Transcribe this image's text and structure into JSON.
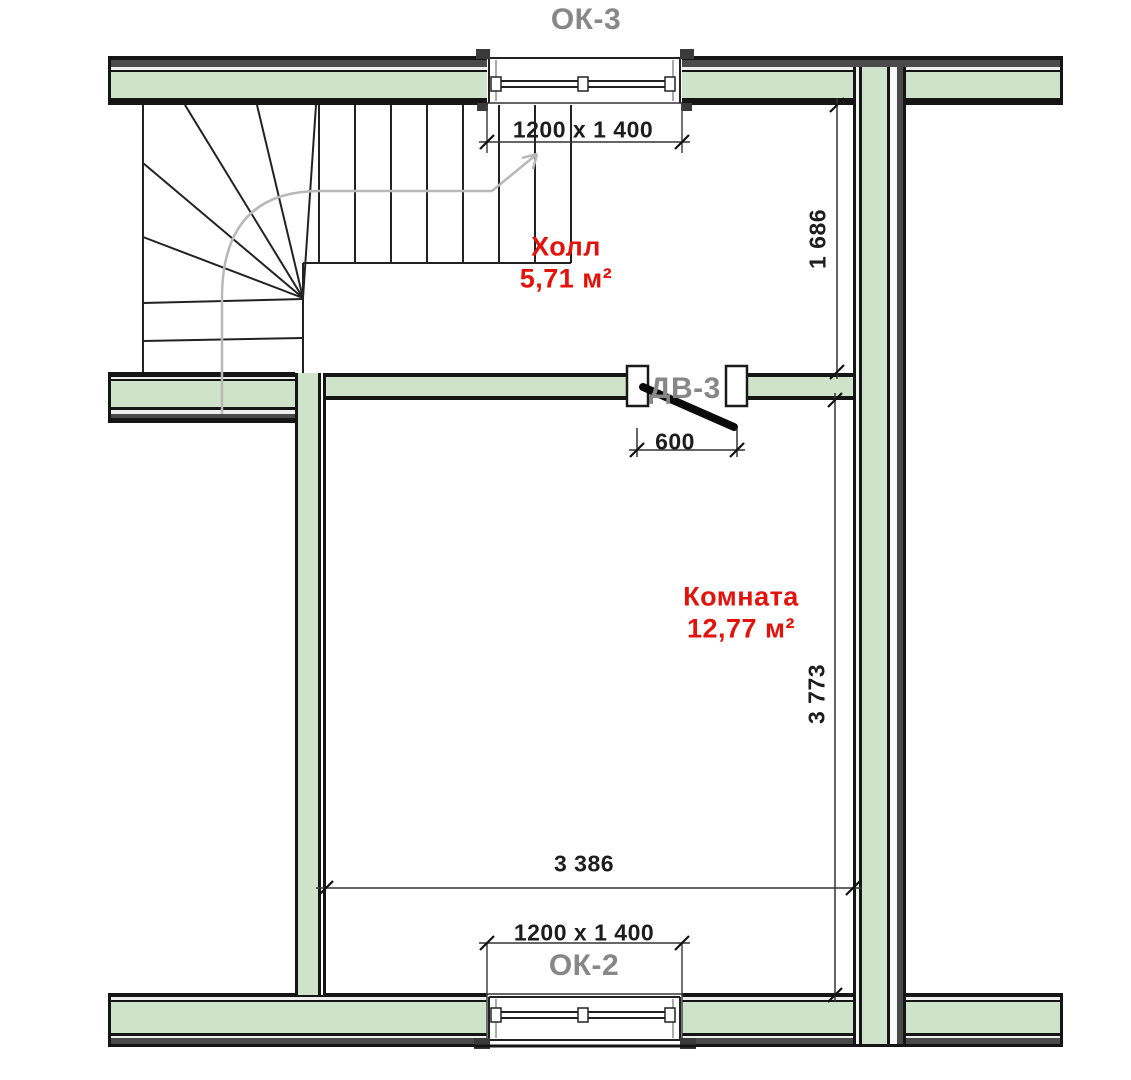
{
  "windows": {
    "ok3": {
      "marker": "ОК-3",
      "size": "1200 x 1 400"
    },
    "ok2": {
      "marker": "ОК-2",
      "size": "1200 x 1 400"
    }
  },
  "door": {
    "marker": "ДВ-3",
    "width": "600"
  },
  "rooms": {
    "hall": {
      "name": "Холл",
      "area": "5,71 м²"
    },
    "room": {
      "name": "Комната",
      "area": "12,77 м²"
    }
  },
  "dimensions": {
    "hall_depth": "1 686",
    "room_depth": "3 773",
    "room_width": "3 386"
  },
  "colors": {
    "wall_fill": "#cfe3cb",
    "wall_outline": "#151515",
    "wall_outer_band": "#4a4a4a",
    "room_label": "#e3120b",
    "marker_label": "#878787",
    "dimension_text": "#1d1d1d",
    "walk_line": "#b8b8b8"
  }
}
